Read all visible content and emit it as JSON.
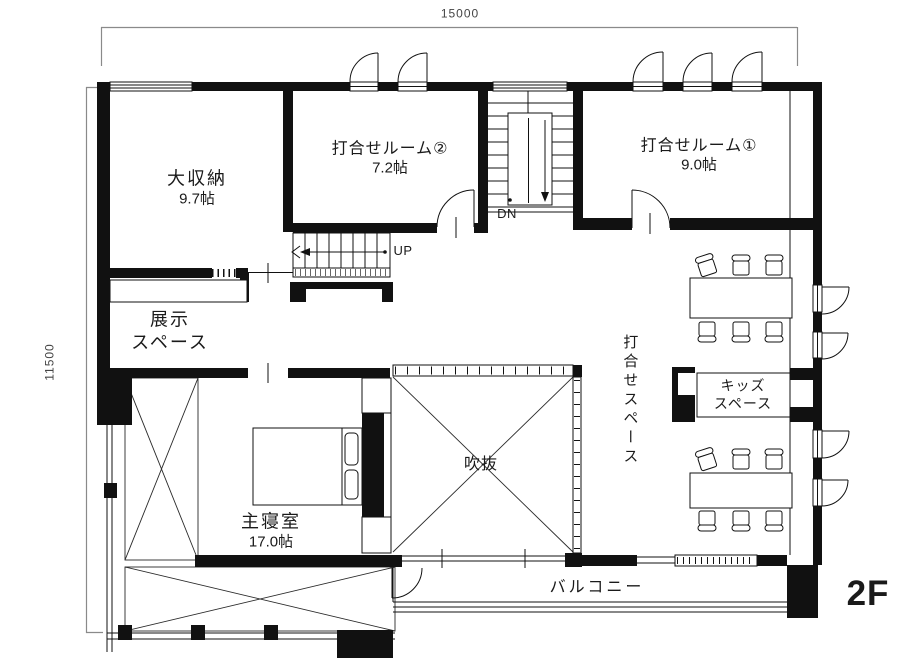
{
  "floor_label": "2F",
  "colors": {
    "ink": "#111111",
    "dim_line": "#8a8a8a",
    "bg": "#ffffff"
  },
  "dimensions": {
    "top": "15000",
    "left": "11500"
  },
  "rooms": {
    "storage": {
      "name": "大収納",
      "area": "9.7帖"
    },
    "meeting2": {
      "name": "打合せルーム②",
      "area": "7.2帖"
    },
    "meeting1": {
      "name": "打合せルーム①",
      "area": "9.0帖"
    },
    "exhibit": {
      "name_line1": "展示",
      "name_line2": "スペース"
    },
    "bedroom": {
      "name": "主寝室",
      "area": "17.0帖"
    },
    "void": {
      "name": "吹抜"
    },
    "meeting_space": {
      "name": "打合せスペース"
    },
    "kids": {
      "name_line1": "キッズ",
      "name_line2": "スペース"
    },
    "balcony": {
      "name": "バルコニー"
    }
  },
  "stairs": {
    "up_label": "UP",
    "down_label": "DN"
  }
}
